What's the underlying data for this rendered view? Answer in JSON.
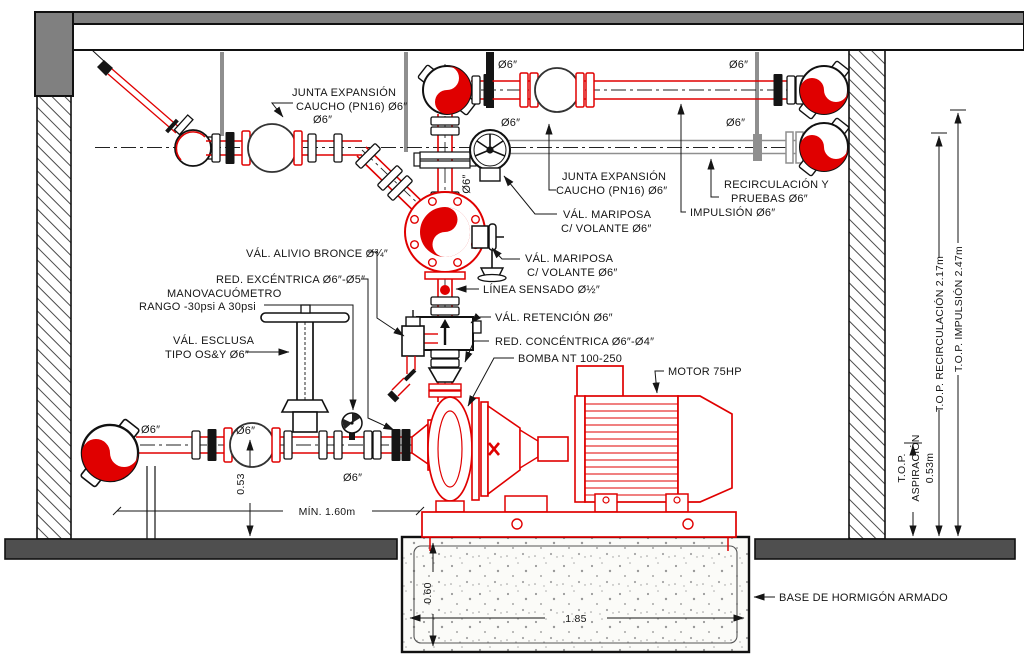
{
  "colors": {
    "pipe_red": "#e00000",
    "line_black": "#151515",
    "structure_gray": "#808080",
    "floor_gray": "#4f4f4f",
    "recirc_gray": "#8f8f8f"
  },
  "labels": {
    "junta_top": {
      "l1": "JUNTA EXPANSIÓN",
      "l2": "CAUCHO (PN16) Ø6″"
    },
    "junta_mid": {
      "l1": "JUNTA EXPANSIÓN",
      "l2": "CAUCHO (PN16) Ø6″"
    },
    "mariposa1": {
      "l1": "VÁL. MARIPOSA",
      "l2": "C/ VOLANTE Ø6″"
    },
    "mariposa2": {
      "l1": "VÁL. MARIPOSA",
      "l2": "C/ VOLANTE Ø6″"
    },
    "linea_sensado": "LÍNEA SENSADO Ø½″",
    "val_retencion": "VÁL. RETENCIÓN Ø6″",
    "red_concentrica": "RED. CONCÉNTRICA Ø6″-Ø4″",
    "bomba": "BOMBA NT 100-250",
    "motor": "MOTOR 75HP",
    "val_alivio": "VÁL. ALIVIO BRONCE Ø¾″",
    "red_excentrica": "RED. EXCÉNTRICA Ø6″-Ø5″",
    "manovacuometro": {
      "l1": "MANOVACUÓMETRO",
      "l2": "RANGO -30psi A 30psi"
    },
    "val_esclusa": {
      "l1": "VÁL. ESCLUSA",
      "l2": "TIPO OS&Y Ø6″"
    },
    "recirculacion": {
      "l1": "RECIRCULACIÓN Y",
      "l2": "PRUEBAS Ø6″"
    },
    "impulsion": "IMPULSIÓN Ø6″",
    "base_hormigon": "BASE DE HORMIGÓN ARMADO",
    "d6": "Ø6″"
  },
  "dims": {
    "top_recirc": "T.O.P. RECIRCULACIÓN 2.17m",
    "top_impulsion": "T.O.P. IMPULSIÓN 2.47m",
    "top_asp1": "T.O.P.",
    "top_asp2": "ASPIRACIÓN",
    "top_asp3": "0.53m",
    "h053": "0.53",
    "min160": "MÍN. 1.60m",
    "base060": "0.60",
    "base185": "1.85"
  }
}
